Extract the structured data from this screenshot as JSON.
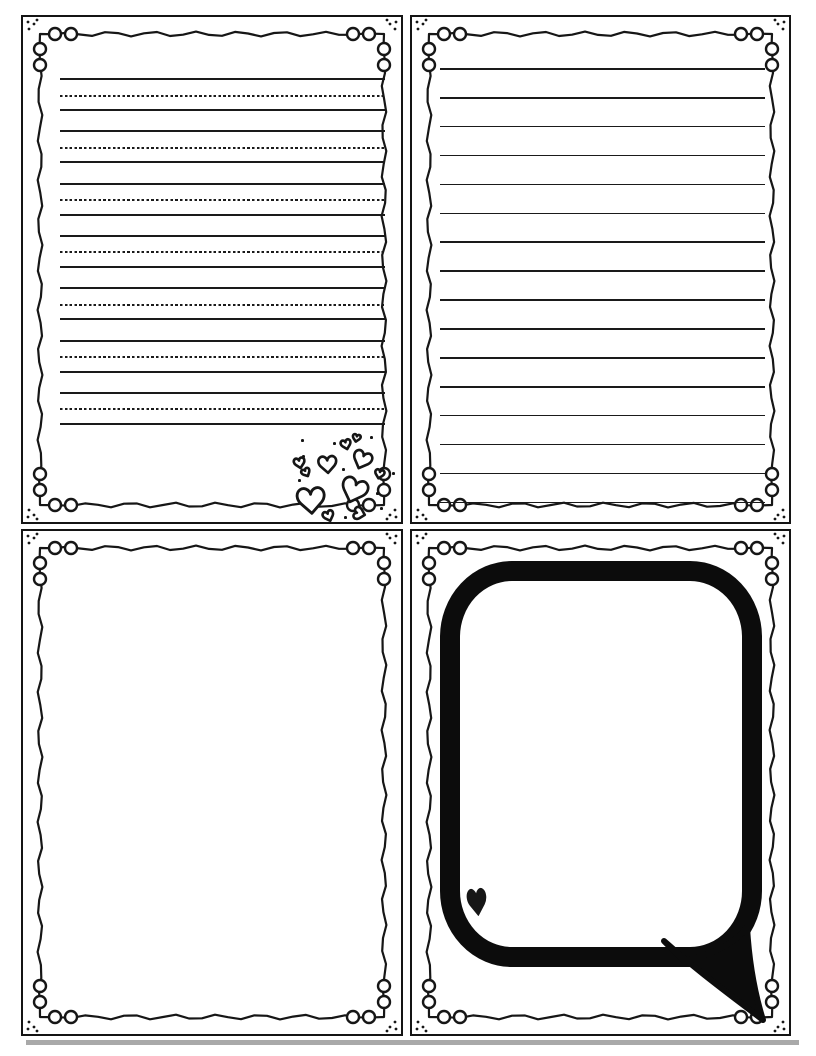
{
  "meta": {
    "title": "Printable four-panel card template with writing lines, hearts and speech bubble"
  },
  "colors": {
    "ink": "#161616",
    "paper": "#ffffff",
    "shadow": "#a9a9a9"
  },
  "glyphs": {
    "heart_outline": "♡",
    "heart_solid": "♥"
  },
  "panels": {
    "top_left": {
      "kind": "primary-handwriting-ruled",
      "groups": 7,
      "group_start": 61,
      "group_spacing": 52.3,
      "dotted_offset": 16.5,
      "bottom_offset": 31,
      "line_left": 37,
      "line_right": 362,
      "hearts": [
        {
          "cx": 323,
          "cy": 427,
          "w": 14,
          "h": 13,
          "rot": -15
        },
        {
          "cx": 333,
          "cy": 421,
          "w": 11,
          "h": 10,
          "rot": 12
        },
        {
          "cx": 339,
          "cy": 443,
          "w": 26,
          "h": 24,
          "rot": 22
        },
        {
          "cx": 276,
          "cy": 446,
          "w": 15,
          "h": 14,
          "rot": -12
        },
        {
          "cx": 304,
          "cy": 447,
          "w": 25,
          "h": 23,
          "rot": -4
        },
        {
          "cx": 283,
          "cy": 455,
          "w": 12,
          "h": 11,
          "rot": -28
        },
        {
          "cx": 356,
          "cy": 457,
          "w": 13,
          "h": 12,
          "rot": 14
        },
        {
          "cx": 288,
          "cy": 483,
          "w": 38,
          "h": 35,
          "rot": -4
        },
        {
          "cx": 331,
          "cy": 473,
          "w": 36,
          "h": 33,
          "rot": 20
        },
        {
          "cx": 336,
          "cy": 496,
          "w": 17,
          "h": 15,
          "rot": -75
        },
        {
          "cx": 305,
          "cy": 499,
          "w": 15,
          "h": 14,
          "rot": -20
        }
      ],
      "dots": [
        [
          279,
          438
        ],
        [
          319,
          451
        ],
        [
          275,
          462
        ],
        [
          353,
          475
        ],
        [
          321,
          499
        ],
        [
          310,
          425
        ],
        [
          347,
          419
        ],
        [
          369,
          455
        ],
        [
          278,
          422
        ],
        [
          357,
          490
        ]
      ]
    },
    "top_right": {
      "kind": "ruled-lines",
      "count": 16,
      "start": 51,
      "spacing": 28.9,
      "line_left": 28,
      "line_right": 353
    },
    "bottom_left": {
      "kind": "blank"
    },
    "bottom_right": {
      "kind": "speech-bubble",
      "heart": {
        "cx": 65,
        "cy": 371,
        "w": 26,
        "h": 36,
        "rot": -6,
        "filled": true
      }
    }
  }
}
